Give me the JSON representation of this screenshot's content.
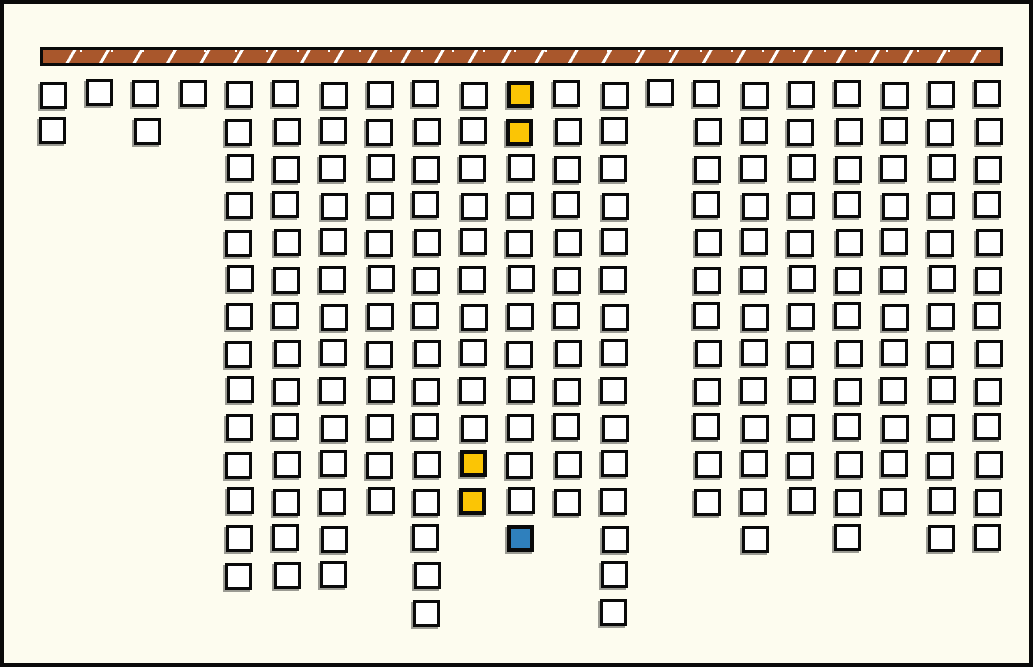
{
  "scene": {
    "background_color": "#FDFCEF",
    "frame_color": "#0A0A0A",
    "frame_thickness": 4,
    "beam": {
      "x": 36,
      "y": 43,
      "width": 963,
      "height": 19,
      "fill_color": "#A9572C",
      "stripe_color": "#FFFFFF",
      "stripe_spacing": 33,
      "border_color": "#0A0A0A"
    },
    "grid": {
      "origin_x": 35,
      "origin_y": 77,
      "col_spacing": 46.8,
      "row_spacing": 37,
      "cell_size": 27,
      "columns_total": 21,
      "rows_total": 15
    },
    "cell_colors": {
      "white": "#FFFFFF",
      "yellow": "#FBC505",
      "blue": "#2F80BD",
      "border": "#0A0A0A",
      "shadow": "#9B9B93"
    },
    "columns": [
      {
        "col": 1,
        "row_from": 0,
        "row_to": 1
      },
      {
        "col": 2,
        "row_from": 0,
        "row_to": 0,
        "raised": true
      },
      {
        "col": 3,
        "row_from": 0,
        "row_to": 1
      },
      {
        "col": 4,
        "row_from": 0,
        "row_to": 0,
        "raised": true
      },
      {
        "col": 5,
        "row_from": 0,
        "row_to": 13
      },
      {
        "col": 6,
        "row_from": 0,
        "row_to": 13
      },
      {
        "col": 7,
        "row_from": 0,
        "row_to": 13
      },
      {
        "col": 8,
        "row_from": 0,
        "row_to": 11
      },
      {
        "col": 9,
        "row_from": 0,
        "row_to": 14
      },
      {
        "col": 10,
        "row_from": 0,
        "row_to": 11
      },
      {
        "col": 11,
        "row_from": 0,
        "row_to": 12
      },
      {
        "col": 12,
        "row_from": 0,
        "row_to": 11
      },
      {
        "col": 13,
        "row_from": 0,
        "row_to": 14
      },
      {
        "col": 14,
        "row_from": 0,
        "row_to": 0,
        "raised": true
      },
      {
        "col": 15,
        "row_from": 0,
        "row_to": 11
      },
      {
        "col": 16,
        "row_from": 0,
        "row_to": 12
      },
      {
        "col": 17,
        "row_from": 0,
        "row_to": 11
      },
      {
        "col": 18,
        "row_from": 0,
        "row_to": 12
      },
      {
        "col": 19,
        "row_from": 0,
        "row_to": 11
      },
      {
        "col": 20,
        "row_from": 0,
        "row_to": 12
      },
      {
        "col": 21,
        "row_from": 0,
        "row_to": 12
      }
    ],
    "special_cells": [
      {
        "col": 11,
        "row": 0,
        "color": "yellow"
      },
      {
        "col": 11,
        "row": 1,
        "color": "yellow"
      },
      {
        "col": 10,
        "row": 10,
        "color": "yellow"
      },
      {
        "col": 10,
        "row": 11,
        "color": "yellow"
      },
      {
        "col": 11,
        "row": 12,
        "color": "blue"
      }
    ],
    "counts": {
      "total_blocks": 216,
      "yellow_blocks": 4,
      "blue_blocks": 1,
      "white_blocks": 211
    }
  }
}
